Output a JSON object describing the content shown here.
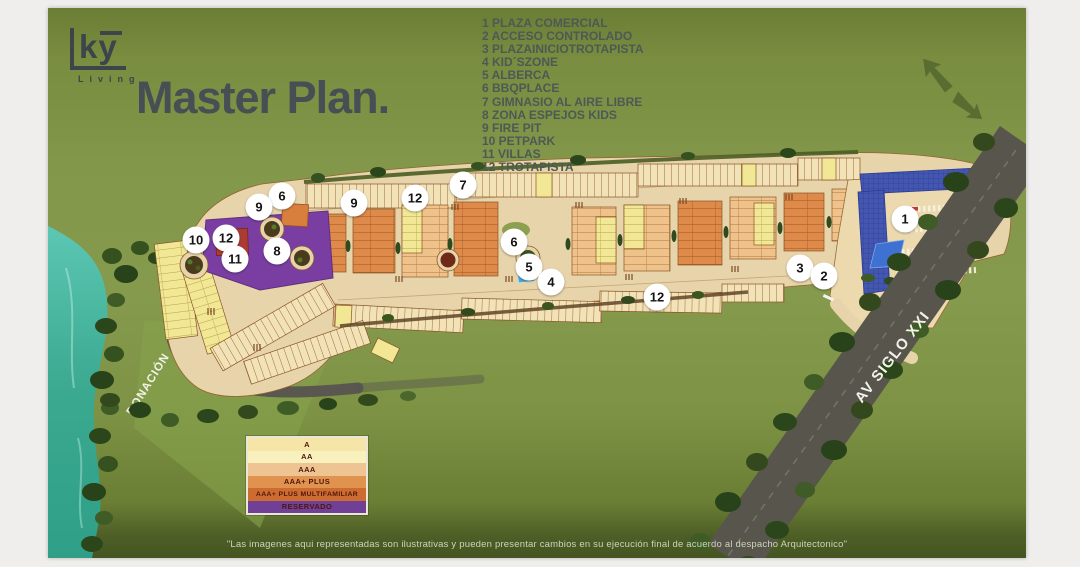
{
  "logo": {
    "brand": "ky",
    "tagline": "Living"
  },
  "header": {
    "title": "Master Plan."
  },
  "poi_legend": {
    "items": [
      {
        "num": "1",
        "label": "PLAZA COMERCIAL"
      },
      {
        "num": "2",
        "label": "ACCESO CONTROLADO"
      },
      {
        "num": "3",
        "label": "PLAZAINICIOTROTAPISTA"
      },
      {
        "num": "4",
        "label": "KID´SZONE"
      },
      {
        "num": "5",
        "label": "ALBERCA"
      },
      {
        "num": "6",
        "label": "BBQPLACE"
      },
      {
        "num": "7",
        "label": "GIMNASIO AL AIRE LIBRE"
      },
      {
        "num": "8",
        "label": "ZONA ESPEJOS KIDS"
      },
      {
        "num": "9",
        "label": "FIRE PIT"
      },
      {
        "num": "10",
        "label": "PETPARK"
      },
      {
        "num": "11",
        "label": "VILLAS"
      },
      {
        "num": "12",
        "label": "TROTAPISTA"
      }
    ]
  },
  "map": {
    "road_labels": {
      "avenue": "AV SIGLO XXI",
      "donation": "DONACIÓN"
    },
    "markers": [
      {
        "num": "6",
        "x": 234,
        "y": 188
      },
      {
        "num": "9",
        "x": 211,
        "y": 199
      },
      {
        "num": "10",
        "x": 148,
        "y": 232
      },
      {
        "num": "12",
        "x": 178,
        "y": 230
      },
      {
        "num": "11",
        "x": 187,
        "y": 251
      },
      {
        "num": "8",
        "x": 229,
        "y": 243
      },
      {
        "num": "9",
        "x": 306,
        "y": 195
      },
      {
        "num": "12",
        "x": 367,
        "y": 190
      },
      {
        "num": "7",
        "x": 415,
        "y": 177
      },
      {
        "num": "6",
        "x": 466,
        "y": 234
      },
      {
        "num": "5",
        "x": 481,
        "y": 259
      },
      {
        "num": "4",
        "x": 503,
        "y": 274
      },
      {
        "num": "12",
        "x": 609,
        "y": 289
      },
      {
        "num": "3",
        "x": 752,
        "y": 260
      },
      {
        "num": "2",
        "x": 776,
        "y": 268
      },
      {
        "num": "1",
        "x": 857,
        "y": 211
      }
    ],
    "colors": {
      "background_green": "#82974a",
      "water": "#3aa98f",
      "roads_tan": "#e8d4aa",
      "reserved_purple": "#7a3ea3",
      "plaza_blue": "#4356b0",
      "multifamiliar_red": "#ab3c33"
    }
  },
  "tier_legend": {
    "rows": [
      {
        "label": "A",
        "color": "#f5e5a6"
      },
      {
        "label": "AA",
        "color": "#f9f1bd"
      },
      {
        "label": "AAA",
        "color": "#eec493"
      },
      {
        "label": "AAA+ PLUS",
        "color": "#e0924f"
      },
      {
        "label": "AAA+ PLUS MULTIFAMILIAR",
        "color": "#cd6c31"
      },
      {
        "label": "RESERVADO",
        "color": "#6f4096"
      }
    ]
  },
  "disclaimer": {
    "text": "\"Las imagenes aqui representadas son ilustrativas y pueden presentar cambios en su ejecución final de acuerdo al despacho Arquitectonico\""
  }
}
